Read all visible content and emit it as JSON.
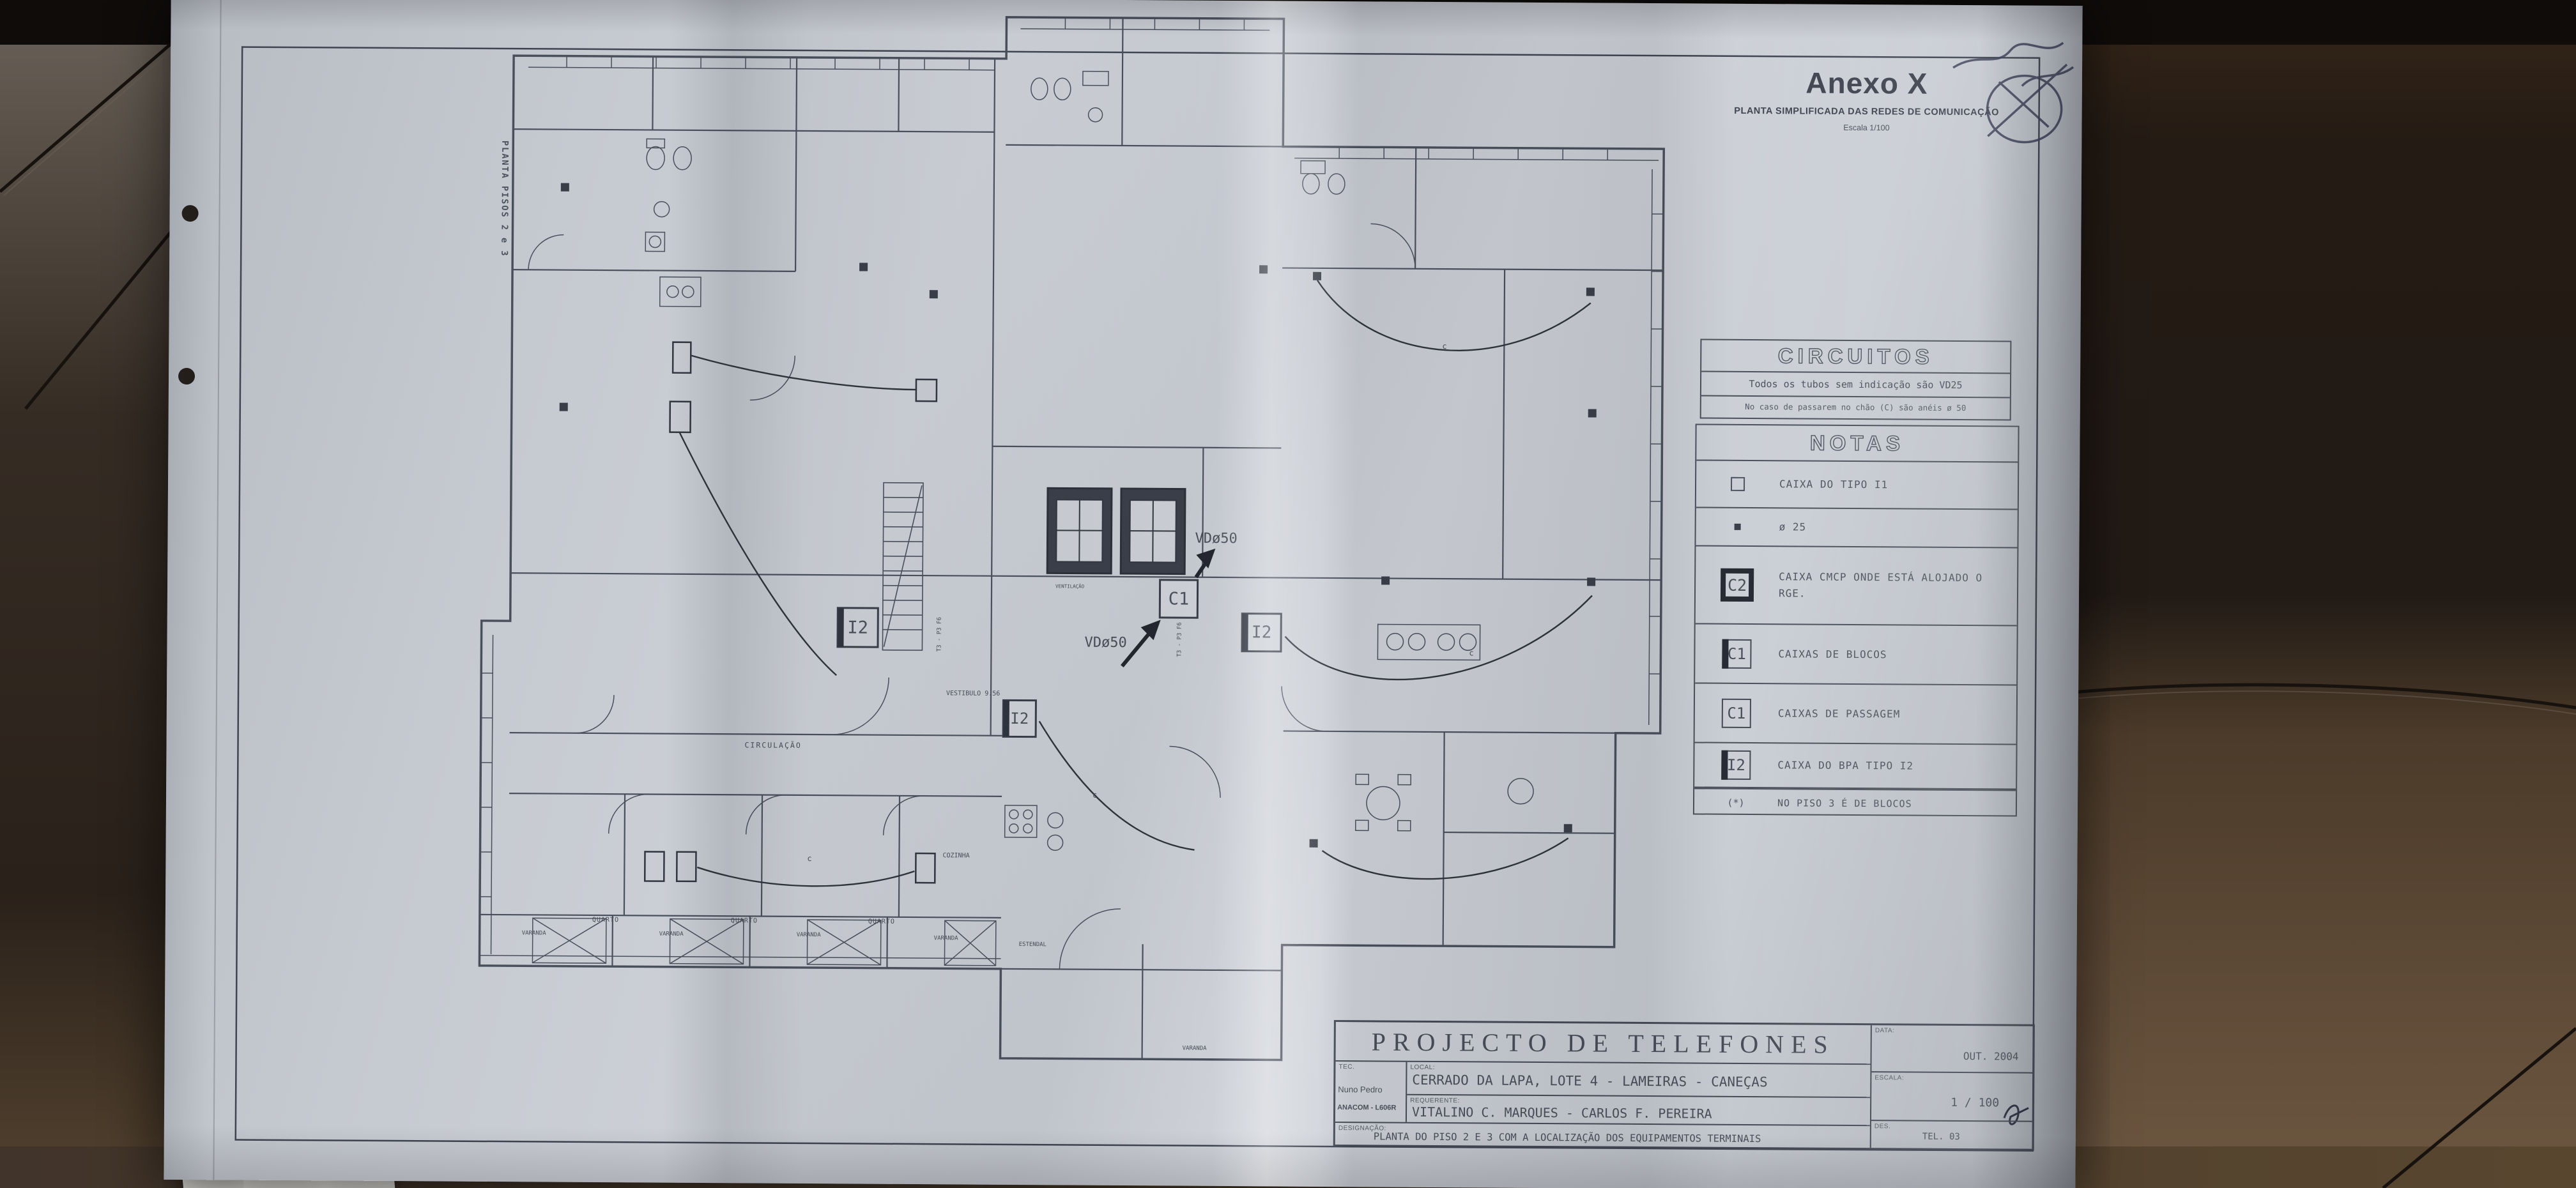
{
  "paper": {
    "side_label": "PLANTA PISOS 2 e 3",
    "annex": {
      "title": "Anexo X",
      "subtitle": "PLANTA SIMPLIFICADA DAS REDES DE COMUNICAÇÃO",
      "scale": "Escala 1/100"
    },
    "circuitos": {
      "title": "CIRCUITOS",
      "line1": "Todos os tubos sem indicação são VD25",
      "line2": "No caso de passarem no chão (C) são anéis ø 50"
    },
    "notas": {
      "title": "NOTAS",
      "rows": [
        {
          "sym": "",
          "label": "CAIXA DO TIPO I1"
        },
        {
          "sym": "",
          "label": "ø 25"
        },
        {
          "sym": "C2",
          "label": "CAIXA CMCP ONDE ESTÁ ALOJADO O RGE."
        },
        {
          "sym": "C1",
          "label": "CAIXAS DE BLOCOS"
        },
        {
          "sym": "C1",
          "label": "CAIXAS DE PASSAGEM"
        },
        {
          "sym": "I2",
          "label": "CAIXA DO BPA TIPO I2"
        }
      ],
      "footnote_marker": "(*)",
      "footnote": "NO PISO 3 É DE BLOCOS"
    },
    "plan": {
      "vd50": "VDø50",
      "c1_box": "C1",
      "i2_box": "I2",
      "cable_c": "c",
      "tipo": "T3 - P3 F6",
      "rooms": {
        "circulacao": "CIRCULAÇÃO",
        "vestibulo": "VESTIBULO 9.56",
        "cozinha": "COZINHA",
        "quarto": "QUARTO",
        "varanda": "VARANDA",
        "estendal": "ESTENDAL",
        "ventilacao": "VENTILAÇÃO"
      }
    },
    "titleblock": {
      "title": "PROJECTO DE TELEFONES",
      "tec_label": "TEC.",
      "tec_name": "Nuno Pedro",
      "tec_id": "ANACOM - L606R",
      "local_label": "LOCAL:",
      "local_value": "CERRADO DA LAPA, LOTE 4 - LAMEIRAS - CANEÇAS",
      "req_label": "REQUERENTE:",
      "req_value": "VITALINO C. MARQUES - CARLOS F. PEREIRA",
      "data_label": "DATA:",
      "data_value": "OUT. 2004",
      "escala_label": "ESCALA:",
      "escala_value": "1 / 100",
      "des_label": "DES.",
      "des_value": "TEL. 03",
      "desig_label": "DESIGNAÇÃO:",
      "desig_value": "PLANTA DO PISO 2 E 3 COM A LOCALIZAÇÃO DOS EQUIPAMENTOS TERMINAIS"
    }
  }
}
